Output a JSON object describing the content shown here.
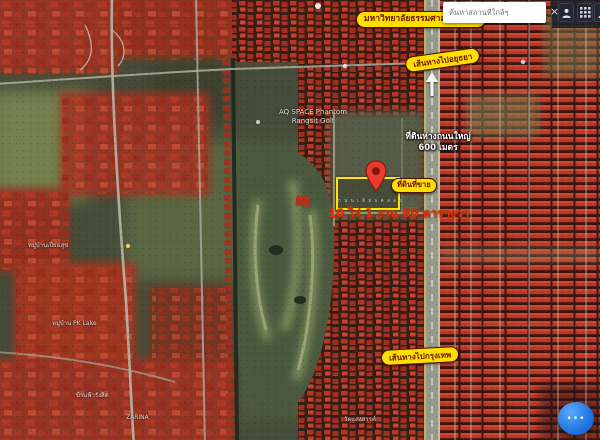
{
  "search": {
    "placeholder": "ค้นหาสถานที่ใกล้ๆ",
    "close_label": "×"
  },
  "labels": {
    "university": "มหาวิทยาลัยธรรมศาสตร์ รังสิต",
    "route_north": "เส้นทางไปอยุธยา",
    "route_bangkok": "เส้นทางไปกรุงเทพ",
    "land_for_sale": "ที่ดินที่ขาย",
    "distance_line1": "ที่ดินห่างถนนใหญ่",
    "distance_line2": "600 เมตร",
    "land_area": "10 ไร่ 1 งาน 80 ตารางวา",
    "plot_caption": "ถ น น เ ลี ย บ ค ล อ ง",
    "poi_line1": "AQ SPACE Phantom",
    "poi_line2": "Rangsit Golf"
  },
  "small_labels": [
    {
      "text": "หมู่บ้านเปี่ยมสุข"
    },
    {
      "text": "หมู่บ้าน PK Lake"
    },
    {
      "text": "บ้านฟ้ารังสิต"
    },
    {
      "text": "ZARINA"
    },
    {
      "text": "วัดแสงสรรค์"
    }
  ],
  "chat_button": {
    "dots": "•••"
  },
  "colors": {
    "highlight_yellow": "#ffdf00",
    "overlay_red": "#c2342a",
    "pin_red": "#ea3b2e",
    "area_text_red": "#f22718",
    "chat_blue": "#1f7fe8"
  }
}
